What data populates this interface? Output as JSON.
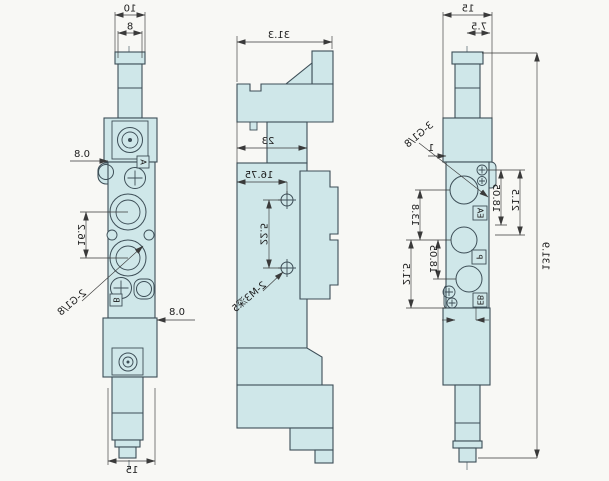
{
  "drawing": {
    "type": "technical-three-view-valve-drawing",
    "mirrored": true,
    "colors": {
      "body_fill": "#cfe7e9",
      "outline": "#3d4e57",
      "dimension": "#3a3a3a",
      "background": "#f8f8f5"
    },
    "front_view": {
      "dim_stem_outer": "10",
      "dim_stem_inner": "8",
      "dim_top_offset": "0.8",
      "dim_port_spacing": "16.2",
      "label_ports": "2-G1/8",
      "dim_bottom_offset": "0.8",
      "dim_base_width": "15",
      "label_port_a": "A",
      "label_port_b": "B"
    },
    "side_view": {
      "dim_depth_overall": "31.3",
      "dim_depth_body": "23",
      "dim_hole_offset": "16.75",
      "dim_hole_spacing": "22.5",
      "label_mounting_holes": "2-M3深5"
    },
    "back_view": {
      "dim_width": "15",
      "dim_half_width": "7.5",
      "dim_face_offset": "1",
      "label_ports": "3-G1/8",
      "dim_side_inner": "18.05",
      "dim_side_outer": "21.5",
      "dim_port_top": "13.8",
      "dim_port_mid": "18.05",
      "dim_port_outer": "21.5",
      "dim_overall_height": "131.9",
      "label_port_ea": "EA",
      "label_port_p": "P",
      "label_port_eb": "EB"
    }
  }
}
